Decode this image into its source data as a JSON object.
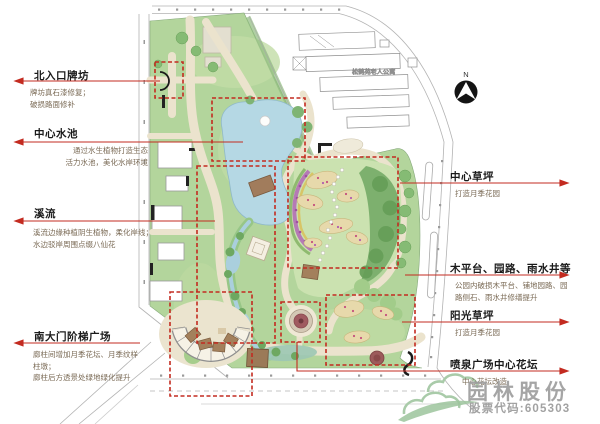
{
  "annotations": {
    "left": [
      {
        "title": "北入口牌坊",
        "desc": "牌坊真石漆修复；\n破损路面修补"
      },
      {
        "title": "中心水池",
        "desc": "通过水生植物打造生态\n活力水池，美化水岸环境"
      },
      {
        "title": "溪流",
        "desc": "溪流边缘种植阴生植物，柔化岸线；\n水边驳岸周围点缀八仙花"
      },
      {
        "title": "南大门阶梯广场",
        "desc": "廊柱间增加月季花坛、月季纹样\n柱墩；\n廊柱后方透景处绿地绿化提升"
      }
    ],
    "right": [
      {
        "title": "中心草坪",
        "desc": "打造月季花园"
      },
      {
        "title": "木平台、园路、雨水井等",
        "desc": "公园内破损木平台、铺地园路、园\n路侧石、雨水井修缮提升"
      },
      {
        "title": "阳光草坪",
        "desc": "打造月季花园"
      },
      {
        "title": "喷泉广场中心花坛",
        "desc": "中心花坛改造"
      }
    ]
  },
  "map": {
    "adjacent_building_label": "松鹤苑老人公寓"
  },
  "compass": {
    "north_label": "N"
  },
  "watermark": {
    "company": "园林股份",
    "stock_code": "股票代码:605303"
  },
  "colors": {
    "annotation_red": "#c32b20",
    "dashed_red": "#c42626",
    "park_green": "#b3d59c",
    "pond_blue": "#b5d8e4",
    "path_cream": "#ebe3cd",
    "watermark_gray": "#9e9e9e",
    "watermark_green": "#a5c8a5"
  }
}
